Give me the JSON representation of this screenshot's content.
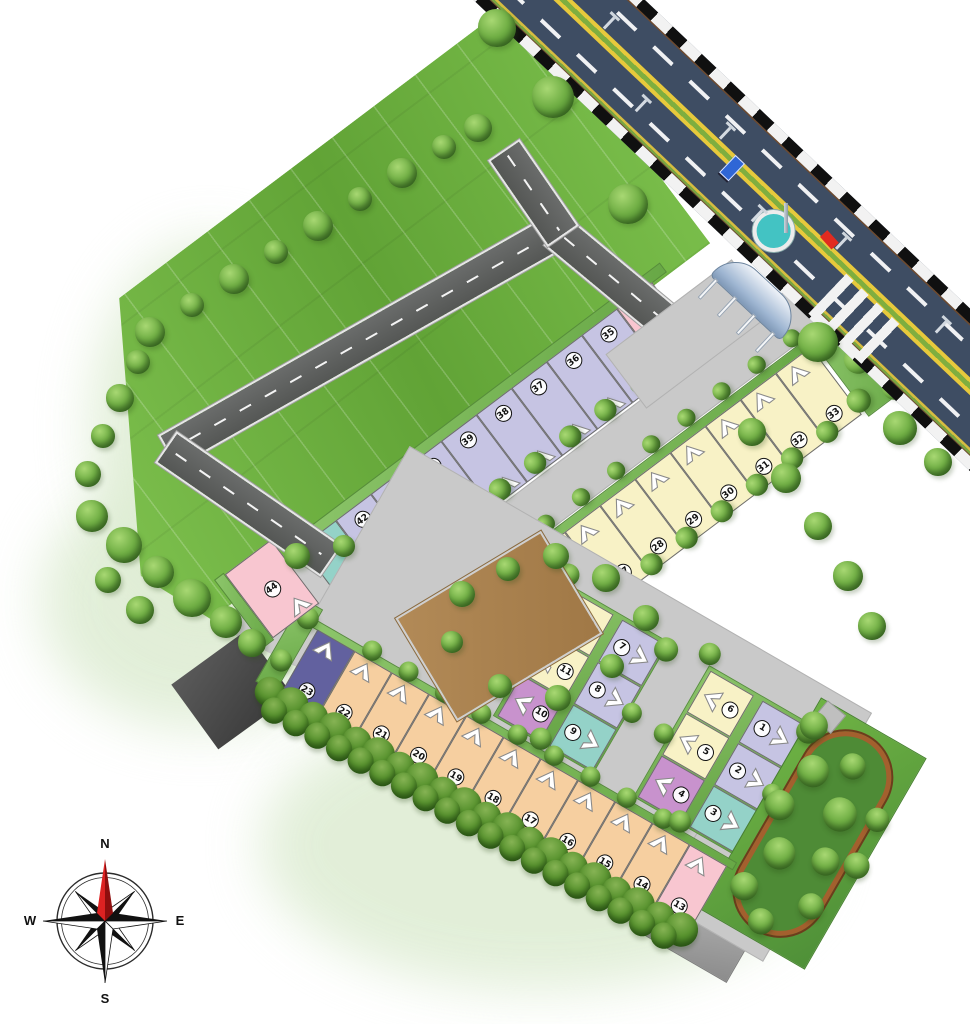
{
  "compass": {
    "north": "N",
    "east": "E",
    "south": "S",
    "west": "W"
  },
  "palette": {
    "lavender": "#c6c4e3",
    "cream": "#f8f2c6",
    "peach": "#f6cfa0",
    "pink": "#f8c6d0",
    "teal": "#94d2c8",
    "purple": "#c892cd",
    "indigo": "#62619f",
    "open_plot_brown": "#ab8352",
    "verge_green": "#7dbd5c",
    "field_green": "#6fb53f",
    "road_dark": "#5f6160",
    "road_light": "#c9c9c9",
    "highway_asphalt": "#3e4d63",
    "median_yellow": "#e7c93c",
    "median_green": "#7fae3f",
    "track_brown": "#a3602e",
    "fountain_teal": "#43c3c3"
  },
  "plots": {
    "row_north": [
      {
        "no": "43",
        "color": "teal"
      },
      {
        "no": "42",
        "color": "lavender"
      },
      {
        "no": "41",
        "color": "lavender"
      },
      {
        "no": "40",
        "color": "lavender"
      },
      {
        "no": "39",
        "color": "lavender"
      },
      {
        "no": "38",
        "color": "lavender"
      },
      {
        "no": "37",
        "color": "lavender"
      },
      {
        "no": "36",
        "color": "lavender"
      },
      {
        "no": "35",
        "color": "lavender"
      },
      {
        "no": "34",
        "color": "pink"
      }
    ],
    "row_middle": [
      {
        "no": "24",
        "color": "purple"
      },
      {
        "no": "25",
        "color": "cream"
      },
      {
        "no": "26",
        "color": "cream"
      },
      {
        "no": "27",
        "color": "cream"
      },
      {
        "no": "28",
        "color": "cream"
      },
      {
        "no": "29",
        "color": "cream"
      },
      {
        "no": "30",
        "color": "cream"
      },
      {
        "no": "31",
        "color": "cream"
      },
      {
        "no": "32",
        "color": "cream"
      },
      {
        "no": "33",
        "color": "cream"
      }
    ],
    "row_south": [
      {
        "no": "23",
        "color": "indigo"
      },
      {
        "no": "22",
        "color": "peach"
      },
      {
        "no": "21",
        "color": "peach"
      },
      {
        "no": "20",
        "color": "peach"
      },
      {
        "no": "19",
        "color": "peach"
      },
      {
        "no": "18",
        "color": "peach"
      },
      {
        "no": "17",
        "color": "peach"
      },
      {
        "no": "16",
        "color": "peach"
      },
      {
        "no": "15",
        "color": "peach"
      },
      {
        "no": "14",
        "color": "peach"
      },
      {
        "no": "13",
        "color": "pink"
      }
    ],
    "cluster_west": {
      "west_column": [
        {
          "no": "12",
          "color": "cream"
        },
        {
          "no": "11",
          "color": "cream"
        },
        {
          "no": "10",
          "color": "purple"
        }
      ],
      "east_column": [
        {
          "no": "7",
          "color": "lavender"
        },
        {
          "no": "8",
          "color": "lavender"
        },
        {
          "no": "9",
          "color": "teal"
        }
      ]
    },
    "cluster_east": {
      "west_column": [
        {
          "no": "6",
          "color": "cream"
        },
        {
          "no": "5",
          "color": "cream"
        },
        {
          "no": "4",
          "color": "purple"
        }
      ],
      "east_column": [
        {
          "no": "1",
          "color": "lavender"
        },
        {
          "no": "2",
          "color": "lavender"
        },
        {
          "no": "3",
          "color": "teal"
        }
      ]
    },
    "standalone": [
      {
        "no": "44",
        "color": "pink"
      }
    ]
  }
}
